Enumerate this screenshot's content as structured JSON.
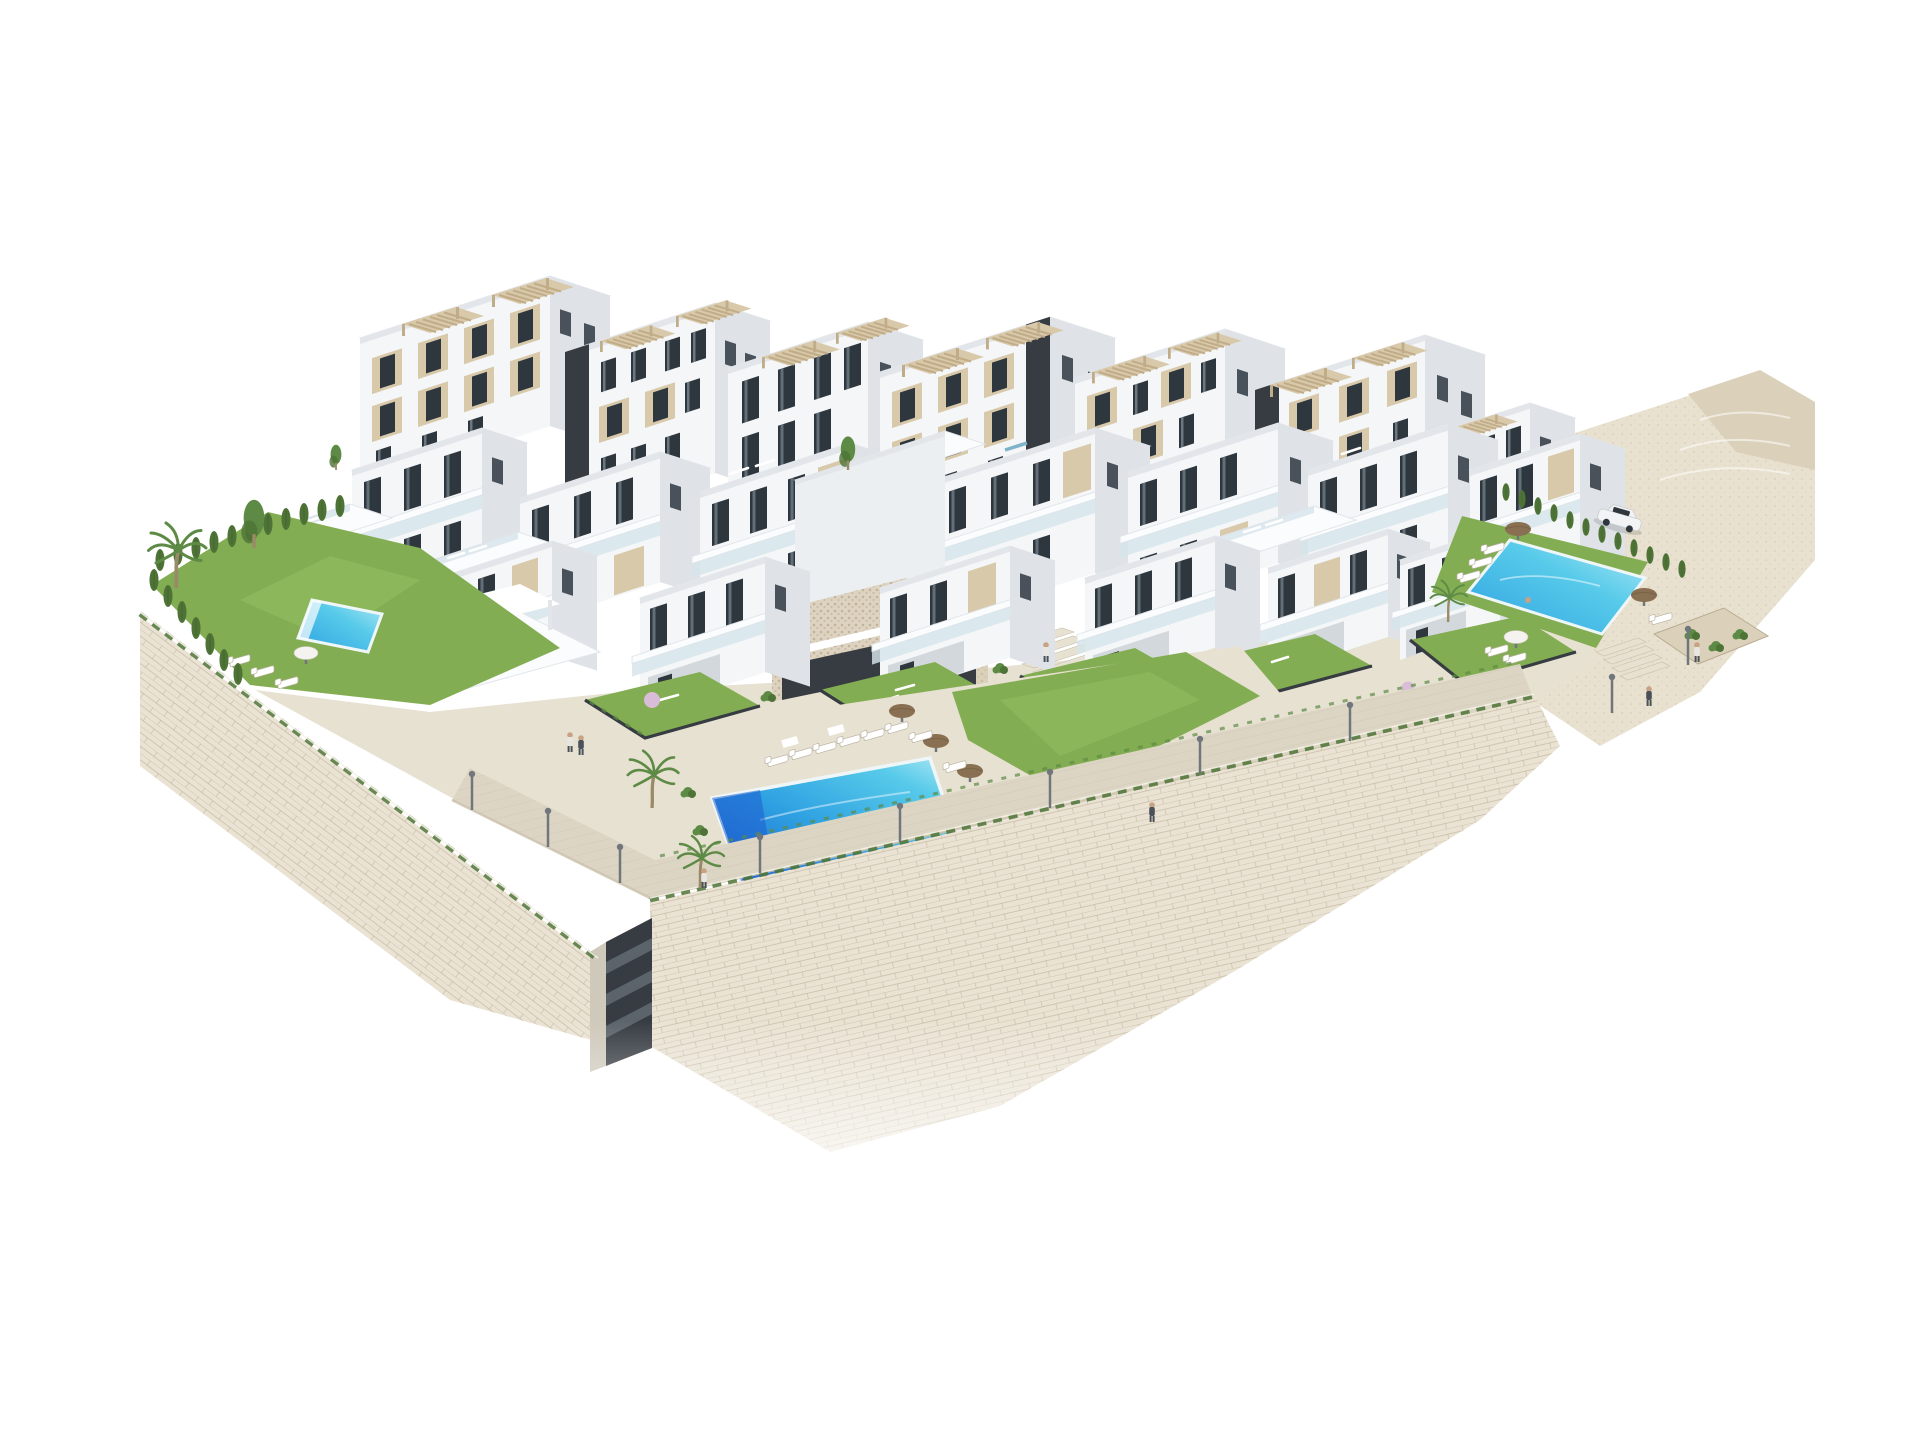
{
  "scene": {
    "type": "3d-architectural-render",
    "view": "aerial-axonometric",
    "description": "Aerial 3D architectural rendering of a white modern hillside apartment complex with rooftop pergolas, glass balconies, three swimming pools, landscaped gardens, cypress hedges, palm trees, street lamps, a parked white car and large stone retaining walls fading to a white background.",
    "counts": {
      "back_row_towers": 7,
      "mid_row_blocks": 7,
      "garden_villas": 6,
      "rooftop_pergolas": 13,
      "swimming_pools": 3,
      "sun_loungers": 16,
      "parasols": 6,
      "street_lamps": 10,
      "palm_trees": 4,
      "people": 9,
      "cars": 1
    }
  },
  "colors": {
    "bg": "#ffffff",
    "bldg_front": "#f4f6f7",
    "bldg_front2": "#eceff1",
    "bldg_side": "#dfe3e7",
    "bldg_side2": "#d3d8dd",
    "roof": "#fbfcfd",
    "roof_edge": "#e2e6ea",
    "beige": "#d9c9ab",
    "beige_dark": "#c1ac88",
    "core_dark": "#363c42",
    "core_band": "#5c646b",
    "win": "#2e363e",
    "win_side": "#49525a",
    "glass": "#d6e4ea",
    "lawn": "#83ad52",
    "lawn_light": "#93bf60",
    "hedge": "#4e7336",
    "tree": "#5d8a44",
    "trunk": "#9b8a68",
    "pave": "#dcd5c4",
    "pave_light": "#e7e1d2",
    "pave_dark": "#c9c0ab",
    "stone_wall": "#eae3d4",
    "stone_wall_dark": "#ddd3c0",
    "stone_line": "#b9ac92",
    "terrain": "#e8e1cf",
    "terrain_rock": "#dbd1ba",
    "parasol": "#8a7052",
    "lamp": "#70767c",
    "pool_deep": "#1e5ecf",
    "pool_mid": "#2fa2e2",
    "pool_aqua": "#58cbea",
    "pool_pale": "#b5e9f4",
    "blossom": "#d9bcd8",
    "skin": "#c9a183",
    "figure_light": "#e8e6e2",
    "figure_dark": "#4a5158"
  }
}
